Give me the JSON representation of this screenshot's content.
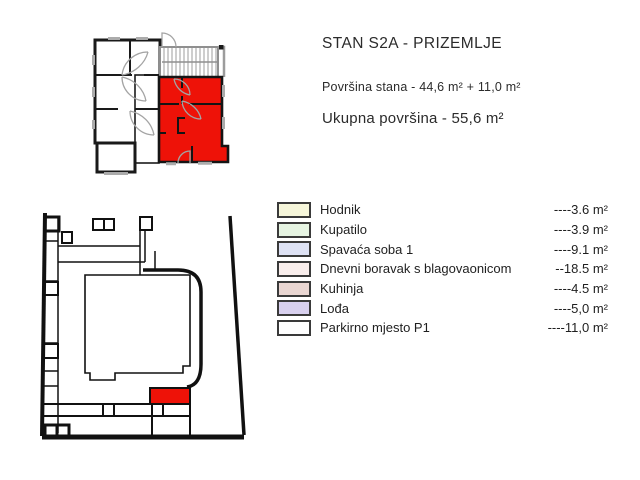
{
  "header": {
    "title": "STAN S2A - PRIZEMLJE",
    "area_line": "Površina stana - 44,6 m² + 11,0 m²",
    "total_line": "Ukupna površina - 55,6 m²"
  },
  "legend": {
    "rows": [
      {
        "label": "Hodnik",
        "value": "----3.6 m²",
        "color": "#f6f6da"
      },
      {
        "label": "Kupatilo",
        "value": "----3.9 m²",
        "color": "#e6f4e2"
      },
      {
        "label": "Spavaća soba 1",
        "value": "----9.1 m²",
        "color": "#dee2f4"
      },
      {
        "label": "Dnevni boravak s blagovaonicom",
        "value": "--18.5 m²",
        "color": "#f9eeec"
      },
      {
        "label": "Kuhinja",
        "value": "----4.5 m²",
        "color": "#e9d6d2"
      },
      {
        "label": "Lođa",
        "value": "----5,0 m²",
        "color": "#d8d0ee"
      },
      {
        "label": "Parkirno mjesto P1",
        "value": "----11,0 m²",
        "color": "#ffffff"
      }
    ]
  },
  "plans": {
    "floor_plan_unit": "S2A",
    "site_plan_parking": "P1"
  },
  "colors": {
    "highlight": "#ee1208",
    "wall_black": "#1a1a1a",
    "wall_gray": "#9c9c9c",
    "text": "#2b2b2b"
  }
}
